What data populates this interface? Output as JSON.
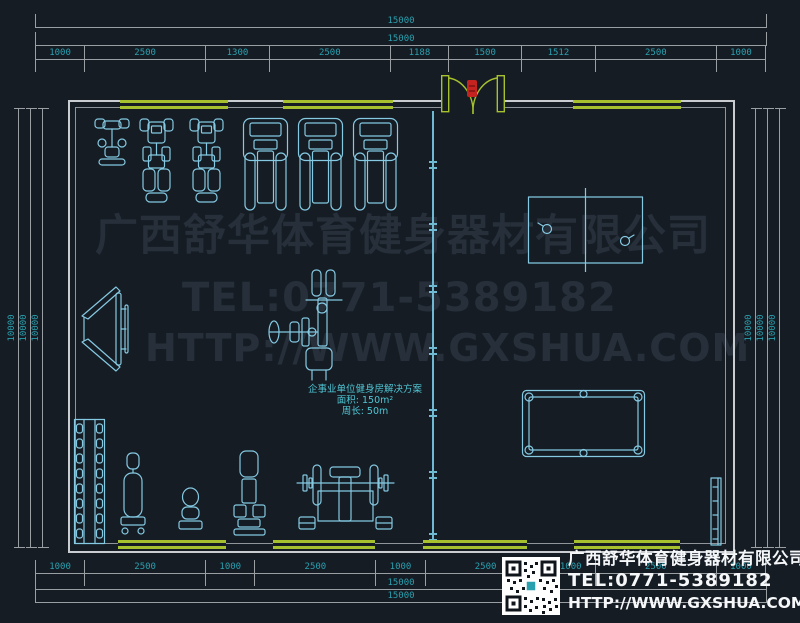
{
  "drawing": {
    "watermark": {
      "line1": "广西舒华体育健身器材有限公司",
      "line2": "TEL:0771-5389182",
      "line3": "HTTP://WWW.GXSHUA.COM"
    },
    "floor_label": {
      "line1": "企事业单位健身房解决方案",
      "line2": "面积: 150m²",
      "line3": "周长: 50m"
    },
    "legend": {
      "company": "广西舒华体育健身器材有限公司",
      "tel": "TEL:0771-5389182",
      "url": "HTTP://WWW.GXSHUA.COM",
      "qr_icon": "qr-code"
    },
    "dimensions": {
      "top": {
        "total_outer": "15000",
        "total_inner": "15000",
        "segments": [
          "1000",
          "2500",
          "1300",
          "2500",
          "1188",
          "1500",
          "1512",
          "2500",
          "1000"
        ]
      },
      "bottom": {
        "segments": [
          "1000",
          "2500",
          "1000",
          "2500",
          "1000",
          "2500",
          "1000",
          "2500",
          "1000"
        ],
        "total_inner": "15000",
        "total_outer": "15000"
      },
      "left": [
        "10000",
        "10000",
        "10000"
      ],
      "right": [
        "10000",
        "10000",
        "10000"
      ]
    },
    "equipment": [
      "exercise-bike",
      "recumbent-bike",
      "recumbent-bike",
      "treadmill",
      "treadmill",
      "treadmill",
      "sit-up-board",
      "multi-station-machine",
      "dumbbell-rack",
      "adjustable-bench",
      "stool",
      "seated-machine",
      "bench-press-station",
      "table-tennis-table",
      "billiard-table",
      "wall-bench"
    ],
    "colors": {
      "background": "#151C24",
      "equipment_line": "#85C9E2",
      "dimension_text": "#2AA0AF",
      "dimension_line": "#9A9FA4",
      "wall_outer": "#C9CDD2",
      "wall_inner": "#8F959B",
      "window_green": "#A6C02E",
      "door_red": "#C42320",
      "legend_text": "#F5F7F9",
      "divider": "#6FB9D2",
      "floor_label": "#4FC6D4"
    }
  }
}
